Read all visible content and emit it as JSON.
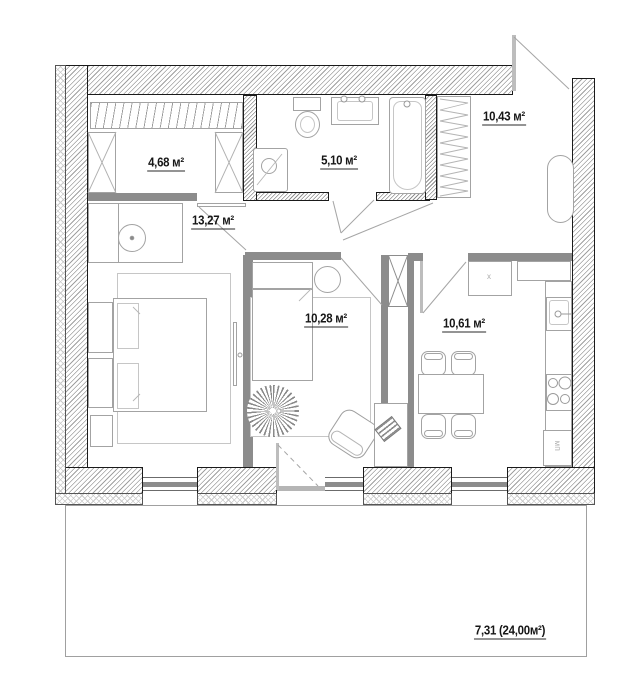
{
  "plan_title": "apartment floor plan",
  "rooms": {
    "wardrobe": {
      "area": "4,68 м²"
    },
    "bathroom": {
      "area": "5,10 м²"
    },
    "hallway": {
      "area": "10,43 м²"
    },
    "living": {
      "area": "13,27 м²"
    },
    "bedroom": {
      "area": "10,28 м²"
    },
    "kitchen": {
      "area": "10,61 м²"
    }
  },
  "balcony": {
    "area": "7,31 (24,00м²)"
  },
  "kitchen_marks": {
    "cabinet_mark": "x",
    "appliance_label": "МП"
  },
  "colors": {
    "wall_hatch": "#9f9f9f",
    "partition": "#8c8c8c",
    "furniture_stroke": "#a3a3a3",
    "label": "#161616"
  }
}
